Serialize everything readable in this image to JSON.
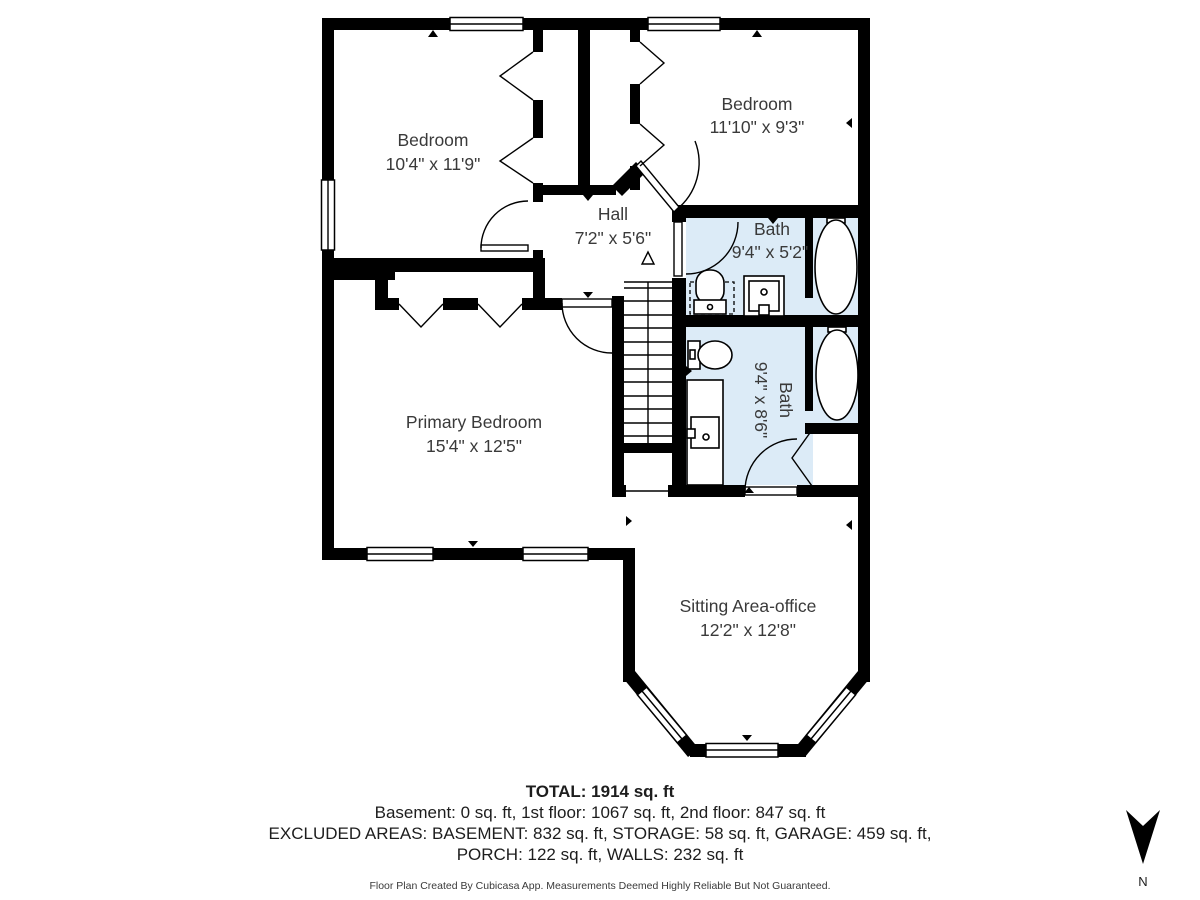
{
  "plan": {
    "rooms": [
      {
        "name": "Bedroom",
        "dims": "10'4\" x 11'9\""
      },
      {
        "name": "Bedroom",
        "dims": "11'10\" x 9'3\""
      },
      {
        "name": "Hall",
        "dims": "7'2\" x 5'6\""
      },
      {
        "name": "Bath",
        "dims": "9'4\" x 5'2\""
      },
      {
        "name": "Bath",
        "dims": "9'4\" x 8'6\""
      },
      {
        "name": "Primary Bedroom",
        "dims": "15'4\" x 12'5\""
      },
      {
        "name": "Sitting Area-office",
        "dims": "12'2\" x 12'8\""
      }
    ],
    "colors": {
      "wall": "#000000",
      "bath_fill": "#dcebf7",
      "floor": "#ffffff"
    },
    "compass_label": "N"
  },
  "summary": {
    "total": "TOTAL: 1914 sq. ft",
    "floors": "Basement: 0 sq. ft, 1st floor: 1067 sq. ft, 2nd floor: 847 sq. ft",
    "excluded_1": "EXCLUDED AREAS: BASEMENT: 832 sq. ft, STORAGE: 58 sq. ft, GARAGE: 459 sq. ft,",
    "excluded_2": "PORCH: 122 sq. ft, WALLS: 232 sq. ft",
    "disclaimer": "Floor Plan Created By Cubicasa App. Measurements Deemed Highly Reliable But Not Guaranteed."
  }
}
